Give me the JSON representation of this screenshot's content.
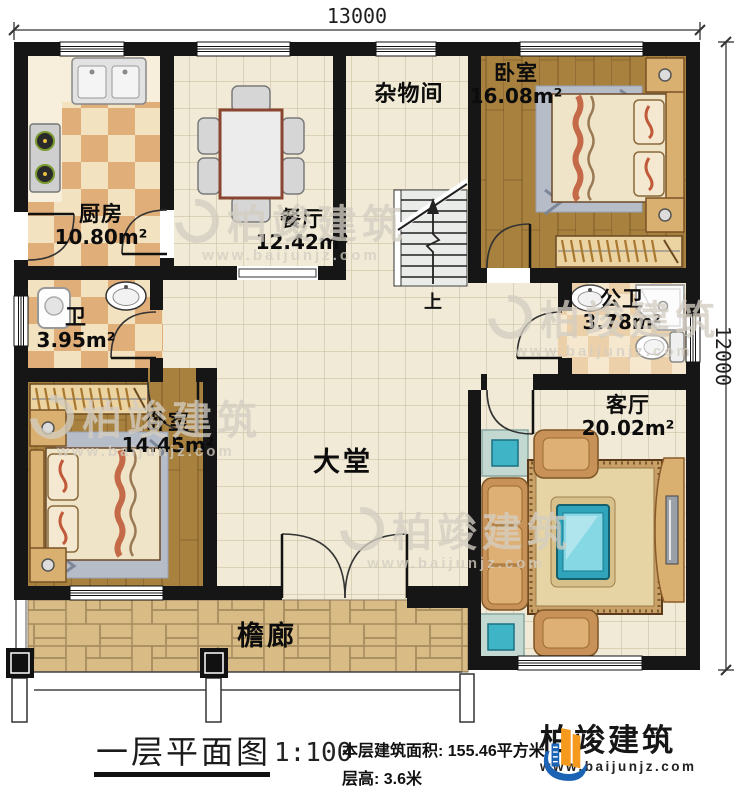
{
  "plan": {
    "dim_top": "13000",
    "dim_right": "12000",
    "stairs_up": "上"
  },
  "rooms": {
    "kitchen": {
      "name": "厨房",
      "area": "10.80m²"
    },
    "dining": {
      "name": "餐厅",
      "area": "12.42m²"
    },
    "storage": {
      "name": "杂物间"
    },
    "bedroom1": {
      "name": "卧室",
      "area": "16.08m²"
    },
    "bath": {
      "name": "卫",
      "area": "3.95m²"
    },
    "public_bath": {
      "name": "公卫",
      "area": "3.78m²"
    },
    "bedroom2": {
      "name": "卧室",
      "area": "14.45m²"
    },
    "hall": {
      "name": "大堂"
    },
    "living": {
      "name": "客厅",
      "area": "20.02m²"
    },
    "porch": {
      "name": "檐廊"
    }
  },
  "title_block": {
    "title": "一层平面图",
    "scale": "1:100",
    "area_line": "本层建筑面积: 155.46平方米",
    "height_line": "层高: 3.6米"
  },
  "branding": {
    "company": "柏竣建筑",
    "website": "www.baijunjz.com"
  },
  "colors": {
    "wall": "#161616",
    "wood_floor": "#a8813f",
    "tile_floor": "#f0ead6",
    "accent_teal": "#2fa4ba",
    "brand_blue": "#1a63b5",
    "brand_orange": "#f59a1d"
  }
}
